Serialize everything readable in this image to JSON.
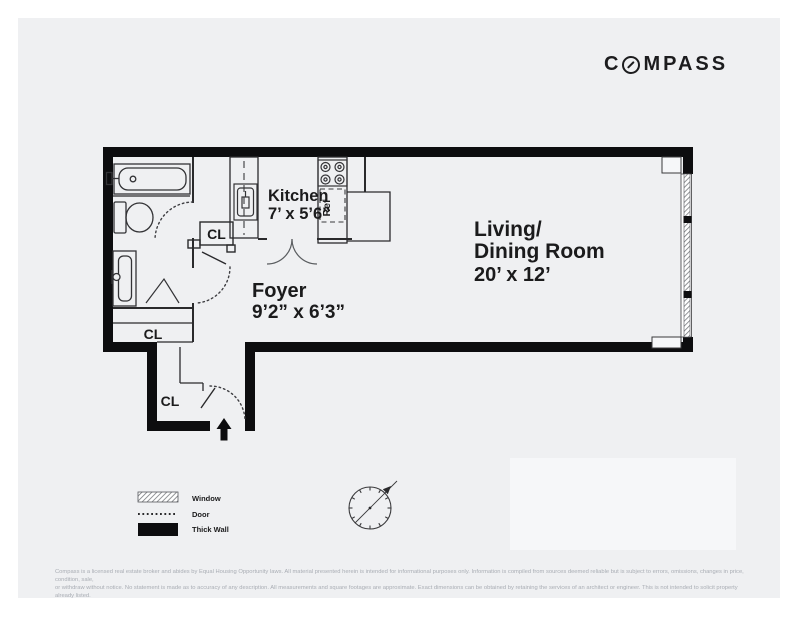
{
  "brand": {
    "logo_full": "COMPASS",
    "logo_before_o": "C",
    "logo_after_o": "MPASS"
  },
  "plan": {
    "kitchen": {
      "name": "Kitchen",
      "dims": "7’ x 5’6”"
    },
    "foyer": {
      "name": "Foyer",
      "dims": "9’2” x 6’3”"
    },
    "living": {
      "line1": "Living/",
      "line2": "Dining Room",
      "dims": "20’ x 12’"
    },
    "closet": "CL",
    "ref": "Ref"
  },
  "legend": {
    "window": "Window",
    "door": "Door",
    "thick_wall": "Thick Wall"
  },
  "disclaimer": {
    "line1": "Compass is a licensed real estate broker and abides by Equal Housing Opportunity laws. All material presented herein is intended for informational purposes only. Information is compiled from sources deemed reliable but is subject to errors, omissions, changes in price, condition, sale,",
    "line2": "or withdraw without notice. No statement is made as to accuracy of any description. All measurements and square footages are approximate. Exact dimensions can be obtained by retaining the services of an architect or engineer. This is not intended to solicit property already listed."
  }
}
